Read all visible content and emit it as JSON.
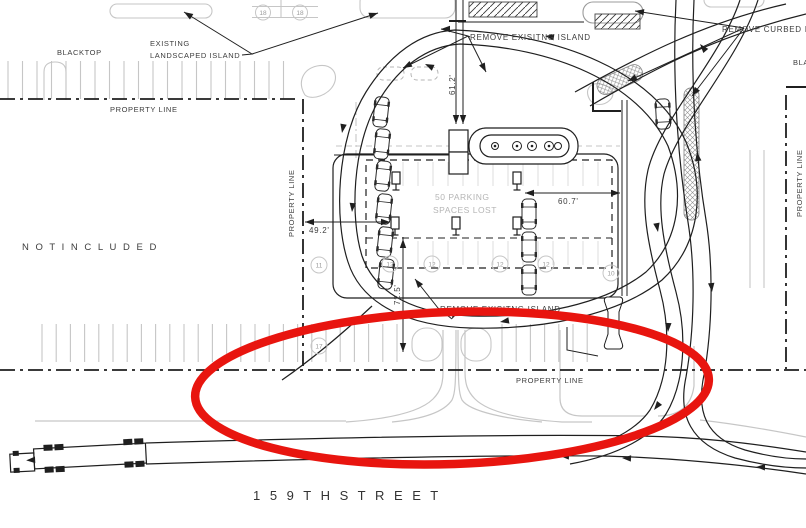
{
  "labels": {
    "property_line": "PROPERTY LINE",
    "blacktop": "BLACKTOP",
    "existing_line1": "EXISTING",
    "existing_line2": "LANDSCAPED ISLAND",
    "remove_island": "REMOVE EXISITNG ISLAND",
    "remove_curbed": "REMOVE CURBED IS",
    "not_included": "N O T   I N C L U D E D",
    "street": "1 5 9 T H   S T R E E T",
    "lost_line1": "50 PARKING",
    "lost_line2": "SPACES LOST"
  },
  "dims": {
    "d61": {
      "label": "61.2'",
      "value": 61.2,
      "unit": "ft"
    },
    "d60": {
      "label": "60.7'",
      "value": 60.7,
      "unit": "ft"
    },
    "d49": {
      "label": "49.2'",
      "value": 49.2,
      "unit": "ft"
    },
    "d72": {
      "label": "72.5'",
      "value": 72.5,
      "unit": "ft"
    }
  },
  "stalls": [
    {
      "value": "18"
    },
    {
      "value": "18"
    },
    {
      "value": "11"
    },
    {
      "value": "12"
    },
    {
      "value": "12"
    },
    {
      "value": "12"
    },
    {
      "value": "12"
    },
    {
      "value": "17"
    },
    {
      "value": "10"
    }
  ],
  "annotation": {
    "type": "red-ellipse-highlight",
    "note": "hand-drawn red oval highlighting driveway along 159th Street"
  },
  "colors": {
    "line": "#1f1f1f",
    "gray": "#c6c6c6",
    "faint": "#dedede",
    "midgray": "#9b9b9b",
    "graytext": "#b5b5b5",
    "text": "#3d3d3d",
    "red": "#e8150f"
  }
}
